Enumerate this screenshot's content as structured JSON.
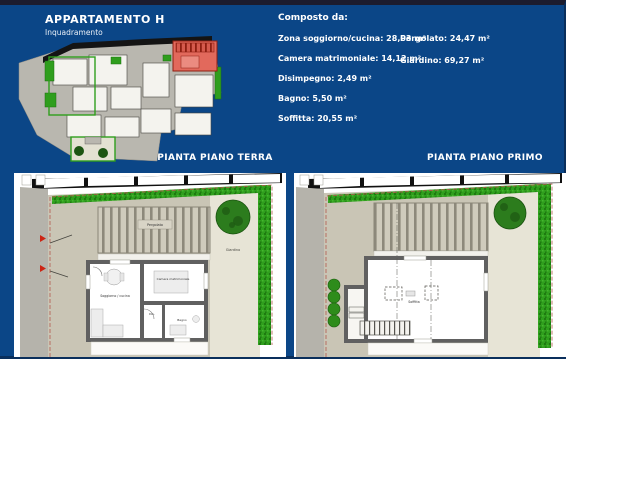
{
  "header": {
    "title": "APPARTAMENTO H",
    "subtitle": "Inquadramento"
  },
  "composto": {
    "heading": "Composto da:",
    "col1": [
      "Zona soggiorno/cucina: 28,03 m²",
      "Camera matrimoniale: 14,12 m²",
      "Disimpegno: 2,49 m²",
      "Bagno: 5,50 m²",
      "Soffitta: 20,55 m²"
    ],
    "col2": [
      "Pergolato: 24,47 m²",
      "Giardino: 69,27 m²"
    ]
  },
  "sections": {
    "terra": "PIANTA PIANO TERRA",
    "primo": "PIANTA PIANO PRIMO"
  },
  "plan_terra": {
    "labels": {
      "pergolato": "Pergolato",
      "giardino": "Giardino",
      "soggiorno": "Soggiorno / cucina",
      "camera": "Camera matrimoniale",
      "bagno": "Bagno",
      "dis": "Dis."
    }
  },
  "plan_primo": {
    "labels": {
      "soffitta": "Soffitta"
    }
  },
  "colors": {
    "board_blue": "#0b4687",
    "garden_green": "#2f9e1d",
    "highlight_red": "#e2695c",
    "terrain_tan": "#c9c5b5"
  }
}
